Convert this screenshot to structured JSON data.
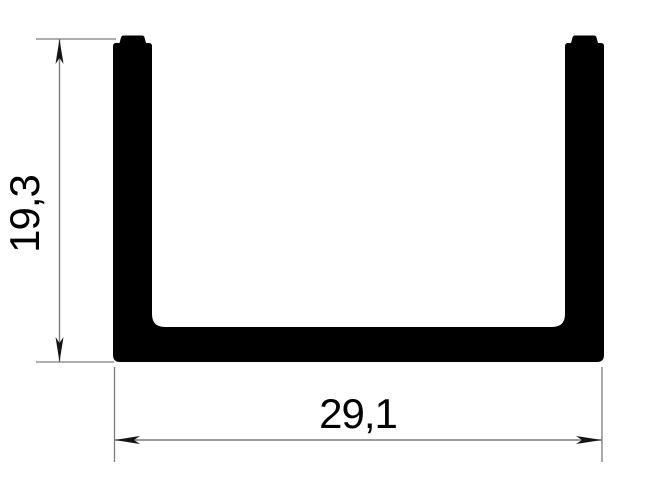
{
  "drawing": {
    "type": "technical-cross-section",
    "shape": "u-channel-profile",
    "height_dimension": {
      "label": "19,3",
      "orientation": "vertical"
    },
    "width_dimension": {
      "label": "29,1",
      "orientation": "horizontal"
    },
    "colors": {
      "profile_fill": "#000000",
      "dimension_line": "#7d7d7d",
      "arrow": "#141414",
      "text": "#000000",
      "background": "#ffffff"
    }
  }
}
